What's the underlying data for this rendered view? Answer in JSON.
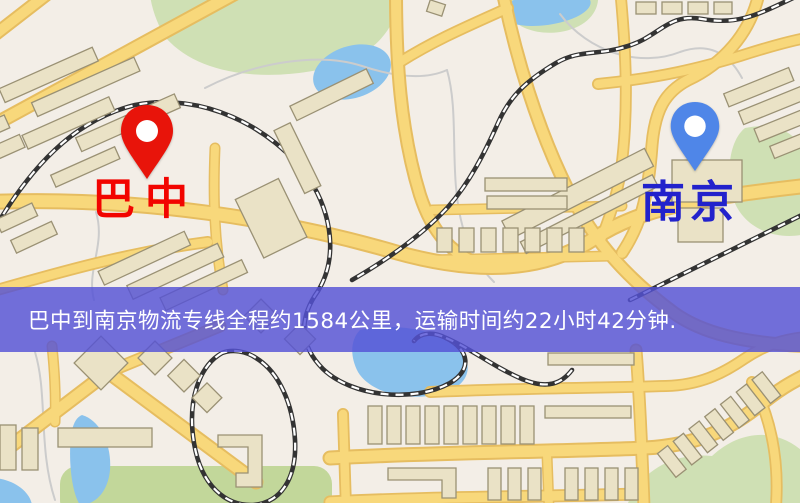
{
  "map": {
    "origin": {
      "name": "巴中",
      "marker": "red-location-pin",
      "marker_color": "#e8140a",
      "label_color": "#f20400"
    },
    "destination": {
      "name": "南京",
      "marker": "blue-location-pin",
      "marker_color": "#4f86e8",
      "label_color": "#2222cc"
    }
  },
  "banner": {
    "text": "巴中到南京物流专线全程约1584公里，运输时间约22小时42分钟.",
    "background_color": "rgba(84,82,214,0.82)",
    "text_color": "#ffffff"
  },
  "palette": {
    "land": "#f3eee7",
    "road_fill": "#f8d87b",
    "road_casing": "#e6bd60",
    "building_fill": "#eae2c6",
    "building_stroke": "#9a9174",
    "park": "#cfe0b4",
    "park_dark": "#c2d79a",
    "water": "#8ac2ec",
    "railway_dark": "#333333",
    "railway_light": "#ffffff",
    "trail": "#cccccc"
  }
}
